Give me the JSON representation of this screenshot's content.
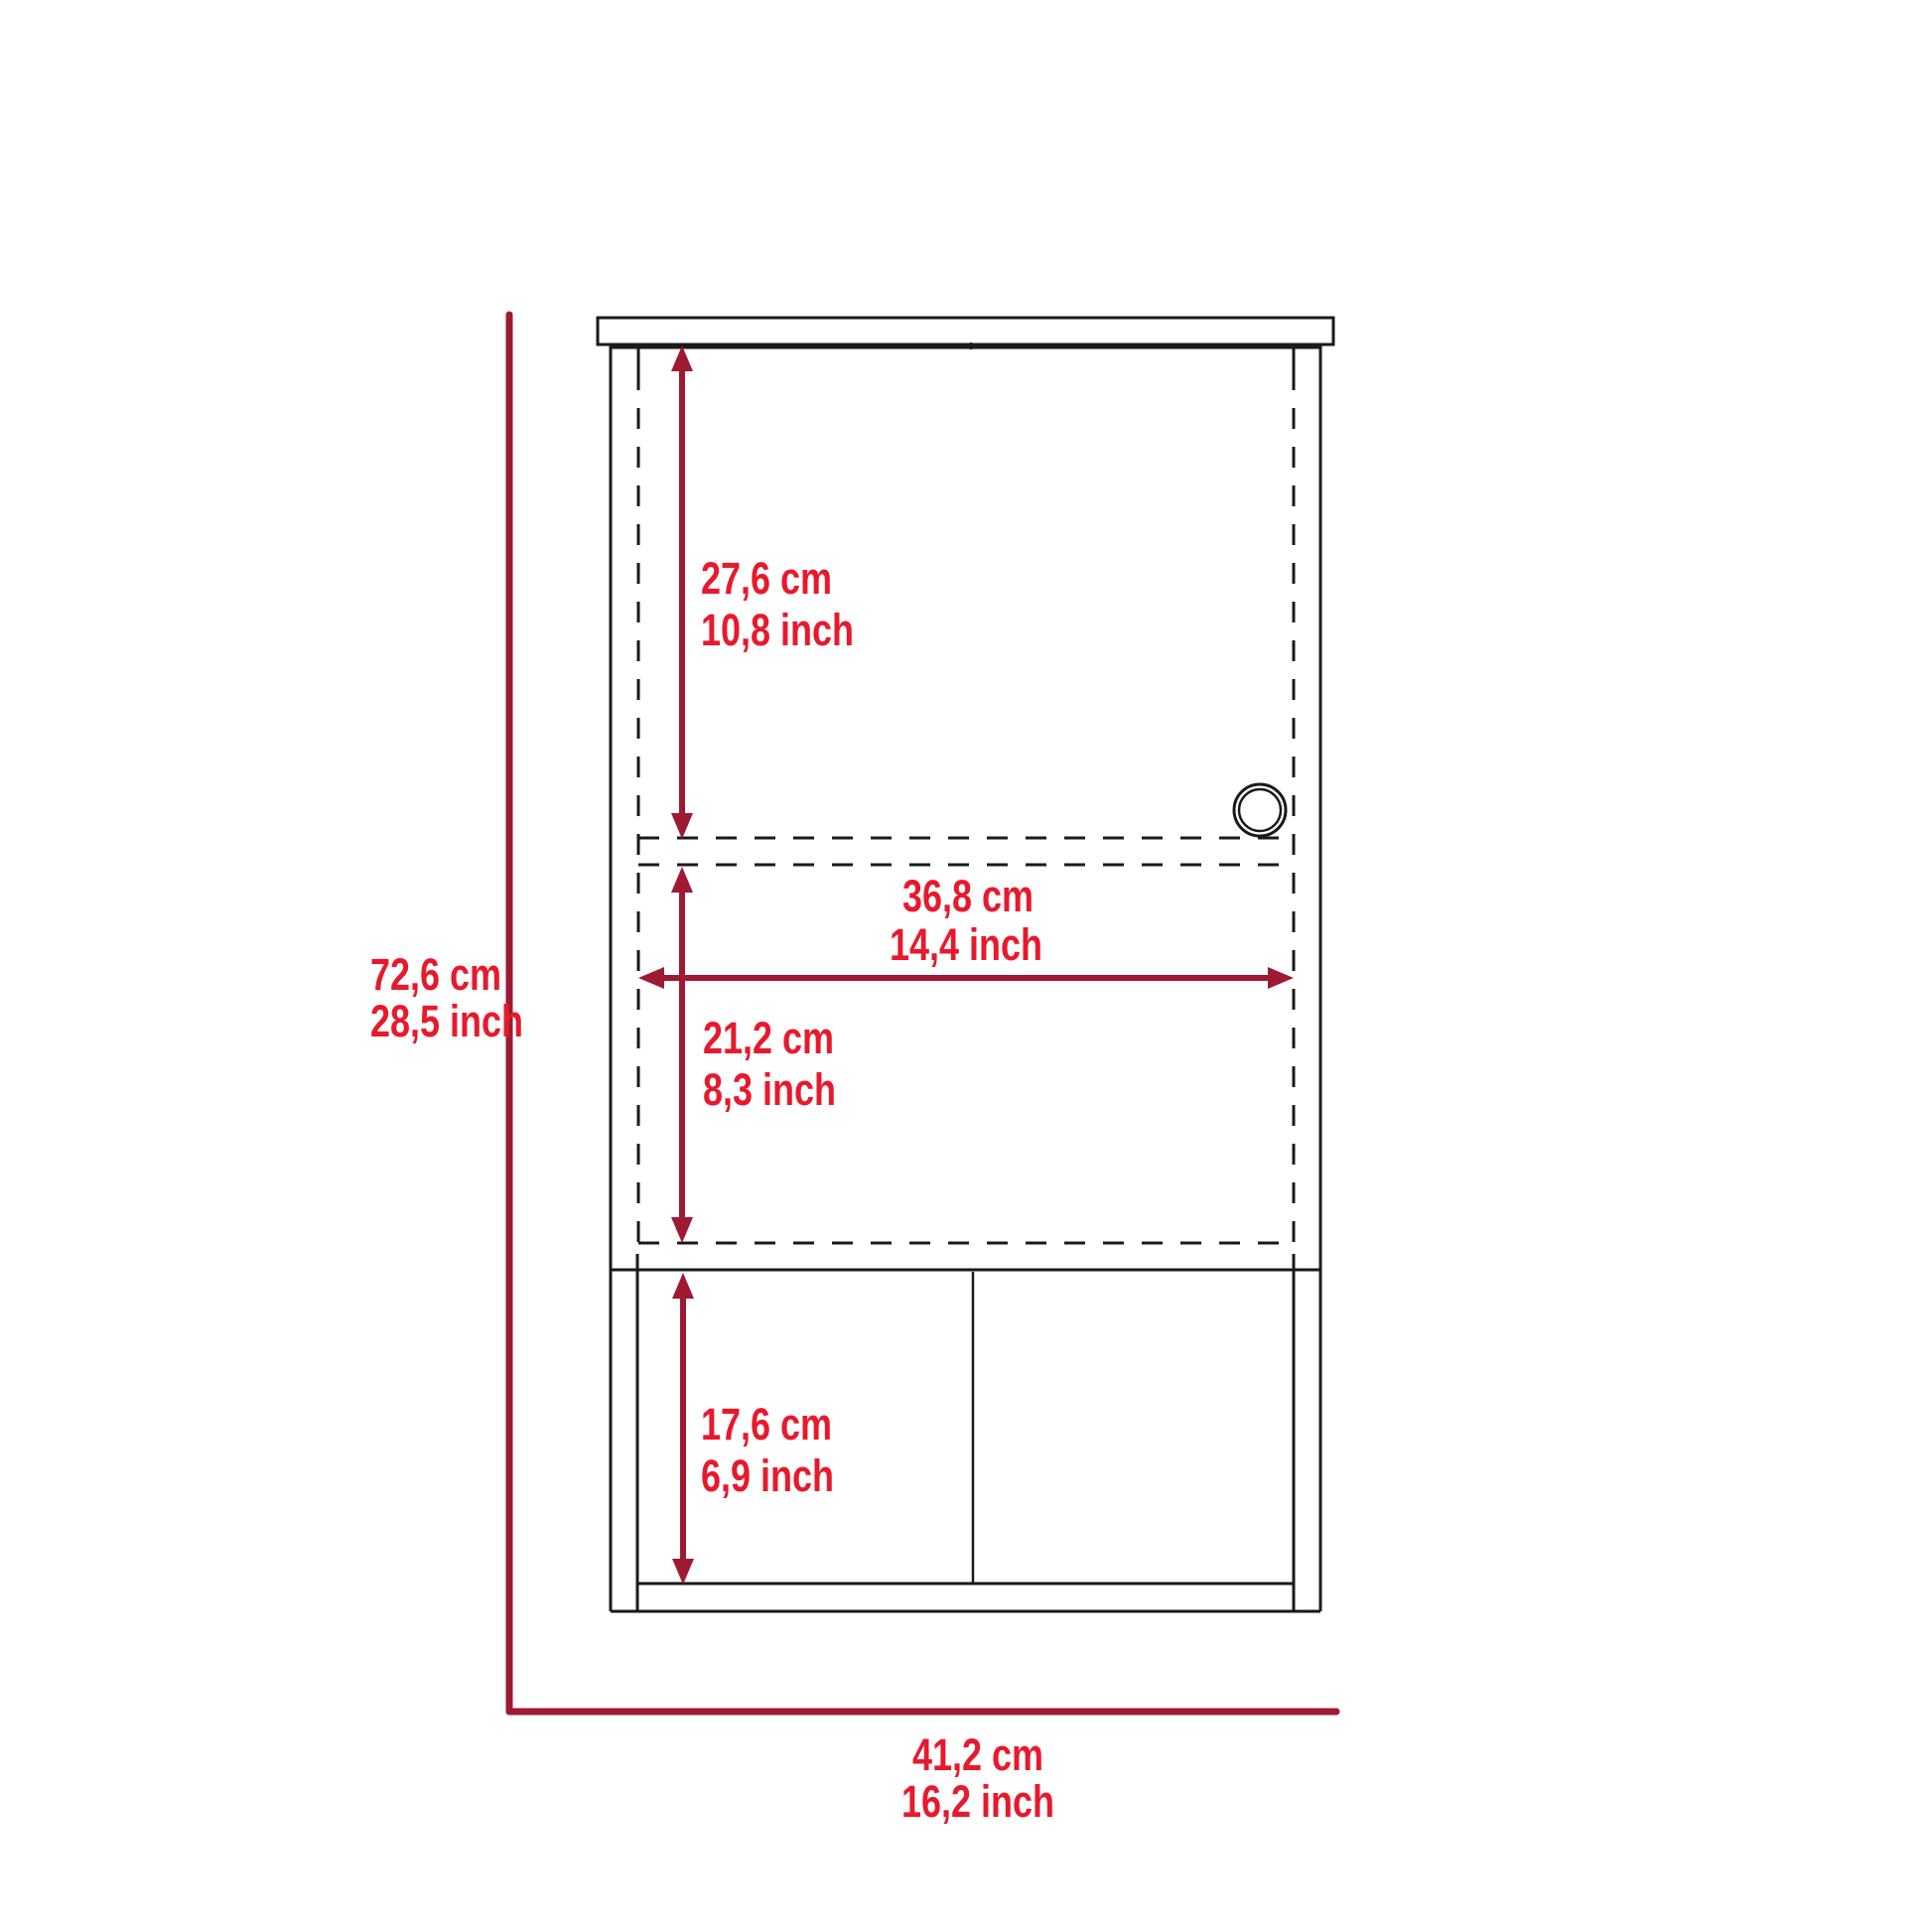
{
  "diagram": {
    "kind": "furniture-dimension-drawing",
    "subject": "wall cabinet with sliding door, open shelf and two-compartment base",
    "colors": {
      "background": "#ffffff",
      "outline": "#1a1a1a",
      "dimension_line": "#9e1a33",
      "dimension_text": "#e8192c"
    },
    "dimensions": {
      "door_height": {
        "cm": "27,6 cm",
        "inch": "10,8 inch"
      },
      "inner_width": {
        "cm": "36,8 cm",
        "inch": "14,4 inch"
      },
      "middle_height": {
        "cm": "21,2 cm",
        "inch": "8,3 inch"
      },
      "bottom_height": {
        "cm": "17,6 cm",
        "inch": "6,9 inch"
      },
      "total_height": {
        "cm": "72,6 cm",
        "inch": "28,5 inch"
      },
      "total_width": {
        "cm": "41,2 cm",
        "inch": "16,2 inch"
      }
    }
  }
}
